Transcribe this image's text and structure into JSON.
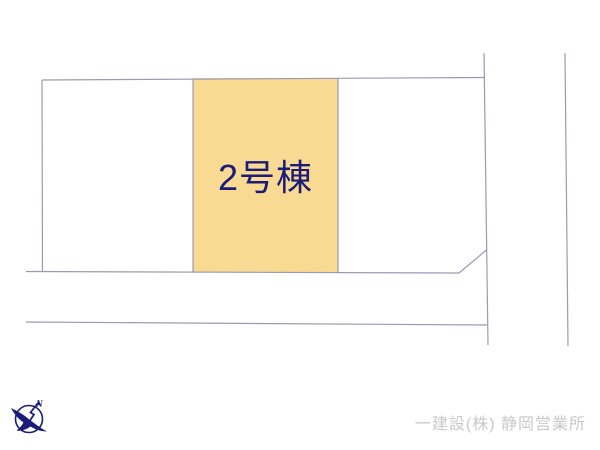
{
  "site_plan": {
    "parcel_label": "2号棟"
  },
  "compass": {
    "north_label": "N"
  },
  "footer": {
    "company_name": "一建設(株) 静岡営業所"
  },
  "colors": {
    "background": "#FFFFFF",
    "parcel-fill": "#F8DA93",
    "line": "#9A9AB8",
    "label-navy": "#1B1B78",
    "watermark-gray": "#C9C9C9"
  }
}
